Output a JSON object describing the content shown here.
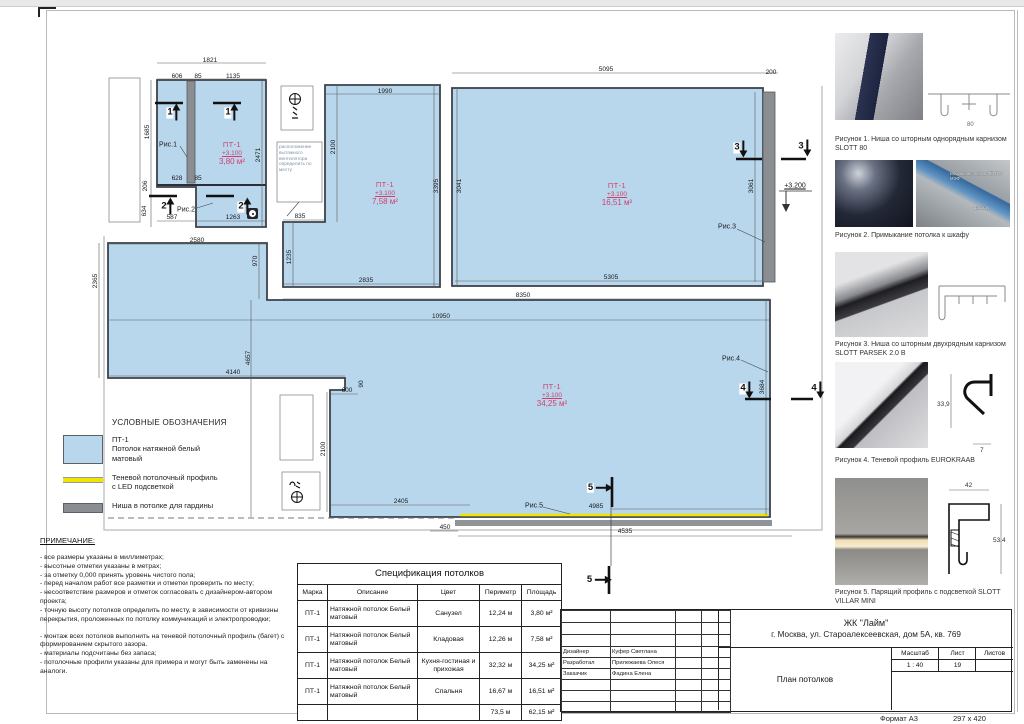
{
  "colors": {
    "ceiling_fill": "#b9d7ec",
    "led_yellow": "#f0e400",
    "niche_gray": "#8a8d92",
    "room_label_pink": "#cf3f6e"
  },
  "plan": {
    "rooms": [
      {
        "mark": "ПТ-1",
        "level": "+3.100",
        "area": "3,80 м²",
        "x": 232,
        "y": 141
      },
      {
        "mark": "ПТ-1",
        "level": "+3.100",
        "area": "7,58 м²",
        "x": 385,
        "y": 181
      },
      {
        "mark": "ПТ-1",
        "level": "+3.100",
        "area": "16,51 м²",
        "x": 617,
        "y": 182
      },
      {
        "mark": "ПТ-1",
        "level": "+3.100",
        "area": "34,25 м²",
        "x": 552,
        "y": 383
      }
    ],
    "niche_level": "+3.200",
    "fan_note": "расположение вытяжного вентилятора определить по месту",
    "dims": [
      {
        "t": "1821",
        "x": 210,
        "y": 61
      },
      {
        "t": "606",
        "x": 177,
        "y": 77
      },
      {
        "t": "85",
        "x": 198,
        "y": 77
      },
      {
        "t": "1135",
        "x": 233,
        "y": 77
      },
      {
        "t": "1685",
        "x": 148,
        "y": 132,
        "v": 1
      },
      {
        "t": "206",
        "x": 146,
        "y": 186,
        "v": 1
      },
      {
        "t": "634",
        "x": 145,
        "y": 211,
        "v": 1
      },
      {
        "t": "628",
        "x": 177,
        "y": 179
      },
      {
        "t": "85",
        "x": 198,
        "y": 179
      },
      {
        "t": "587",
        "x": 172,
        "y": 218
      },
      {
        "t": "1263",
        "x": 233,
        "y": 218
      },
      {
        "t": "2471",
        "x": 259,
        "y": 155,
        "v": 1
      },
      {
        "t": "1990",
        "x": 385,
        "y": 92
      },
      {
        "t": "2100",
        "x": 334,
        "y": 147,
        "v": 1
      },
      {
        "t": "3395",
        "x": 437,
        "y": 186,
        "v": 1
      },
      {
        "t": "835",
        "x": 300,
        "y": 217
      },
      {
        "t": "1235",
        "x": 290,
        "y": 257,
        "v": 1
      },
      {
        "t": "2835",
        "x": 366,
        "y": 281
      },
      {
        "t": "2580",
        "x": 197,
        "y": 241
      },
      {
        "t": "970",
        "x": 256,
        "y": 261,
        "v": 1
      },
      {
        "t": "5095",
        "x": 606,
        "y": 70
      },
      {
        "t": "200",
        "x": 771,
        "y": 73
      },
      {
        "t": "3041",
        "x": 460,
        "y": 186,
        "v": 1
      },
      {
        "t": "3061",
        "x": 752,
        "y": 186,
        "v": 1
      },
      {
        "t": "5305",
        "x": 611,
        "y": 278
      },
      {
        "t": "8350",
        "x": 523,
        "y": 296
      },
      {
        "t": "10950",
        "x": 441,
        "y": 317
      },
      {
        "t": "2365",
        "x": 96,
        "y": 281,
        "v": 1
      },
      {
        "t": "4657",
        "x": 249,
        "y": 358,
        "v": 1
      },
      {
        "t": "4140",
        "x": 233,
        "y": 373
      },
      {
        "t": "600",
        "x": 347,
        "y": 391
      },
      {
        "t": "90",
        "x": 362,
        "y": 384,
        "v": 1
      },
      {
        "t": "2100",
        "x": 324,
        "y": 449,
        "v": 1
      },
      {
        "t": "2405",
        "x": 401,
        "y": 502
      },
      {
        "t": "450",
        "x": 445,
        "y": 528
      },
      {
        "t": "4535",
        "x": 625,
        "y": 532
      },
      {
        "t": "4985",
        "x": 596,
        "y": 507
      },
      {
        "t": "3684",
        "x": 763,
        "y": 387,
        "v": 1
      }
    ],
    "sections": [
      {
        "n": "1",
        "x": 172,
        "y": 113,
        "d": "up"
      },
      {
        "n": "1",
        "x": 230,
        "y": 113,
        "d": "up"
      },
      {
        "n": "2",
        "x": 166,
        "y": 207,
        "d": "up"
      },
      {
        "n": "2",
        "x": 243,
        "y": 207,
        "d": "up"
      },
      {
        "n": "3",
        "x": 739,
        "y": 148,
        "d": "down"
      },
      {
        "n": "3",
        "x": 803,
        "y": 147,
        "d": "down"
      },
      {
        "n": "4",
        "x": 745,
        "y": 389,
        "d": "down"
      },
      {
        "n": "4",
        "x": 816,
        "y": 389,
        "d": "down"
      },
      {
        "n": "5",
        "x": 599,
        "y": 488,
        "d": "right"
      },
      {
        "n": "5",
        "x": 598,
        "y": 580,
        "d": "right"
      }
    ],
    "fig_refs": [
      {
        "t": "Рис.1",
        "x": 168,
        "y": 145
      },
      {
        "t": "Рис.2",
        "x": 186,
        "y": 210
      },
      {
        "t": "Рис.3",
        "x": 727,
        "y": 227
      },
      {
        "t": "Рис.4",
        "x": 731,
        "y": 359
      },
      {
        "t": "Рис.5",
        "x": 534,
        "y": 506
      }
    ]
  },
  "legend": {
    "title": "УСЛОВНЫЕ ОБОЗНАЧЕНИЯ",
    "items": [
      {
        "swatch": "fill",
        "label": "ПТ-1\nПотолок натяжной белый\nматовый"
      },
      {
        "swatch": "led",
        "label": "Теневой потолочный профиль\nс LED подсветкой"
      },
      {
        "swatch": "niche",
        "label": "Ниша в потолке для гардины"
      }
    ]
  },
  "notes": {
    "title": "ПРИМЕЧАНИЕ:",
    "items": [
      "- все размеры указаны в миллиметрах;",
      "- высотные отметки указаны в метрах;",
      "- за отметку 0,000 принять уровень чистого пола;",
      "- перед началом работ все разметки и отметки проверить по месту;",
      "- несоответствие размеров и отметок согласовать с дизайнером-автором проекта;",
      "- точную высоту потолков определить по месту, в зависимости от кривизны перекрытия, проложенных по потолку коммуникаций и электропроводки;",
      "",
      "- монтаж всех потолков выполнить на теневой потолочный профиль (багет) с формированием скрытого зазора.",
      "- материалы подсчитаны без запаса;",
      "- потолочные профили указаны для примера и могут быть заменены на аналоги."
    ]
  },
  "spec_table": {
    "title": "Спецификация потолков",
    "headers": [
      "Марка",
      "Описание",
      "Цвет",
      "Периметр",
      "Площадь"
    ],
    "rows": [
      [
        "ПТ-1",
        "Натяжной потолок Белый матовый",
        "Санузел",
        "12,24 м",
        "3,80 м²"
      ],
      [
        "ПТ-1",
        "Натяжной потолок Белый матовый",
        "Кладовая",
        "12,26 м",
        "7,58 м²"
      ],
      [
        "ПТ-1",
        "Натяжной потолок Белый матовый",
        "Кухня-гостиная и прихожая",
        "32,32 м",
        "34,25 м²"
      ],
      [
        "ПТ-1",
        "Натяжной потолок Белый матовый",
        "Спальня",
        "16,67 м",
        "16,51 м²"
      ]
    ],
    "total": [
      "",
      "",
      "",
      "73,5 м",
      "62,15 м²"
    ]
  },
  "title_block": {
    "project": "ЖК \"Лайм\"",
    "address": "г. Москва, ул. Староалексеевская, дом 5А, кв. 769",
    "roles": [
      {
        "label": "Дизайнер",
        "name": "Куфер Светлана"
      },
      {
        "label": "Разработал",
        "name": "Прилежаева Олеся"
      },
      {
        "label": "Заказчик",
        "name": "Фадина Елена"
      }
    ],
    "drawing_title": "План потолков",
    "scale_label": "Масштаб",
    "scale": "1 : 40",
    "sheet_label": "Лист",
    "sheet": "19",
    "sheets_label": "Листов",
    "sheets": ""
  },
  "footer": {
    "format_label": "Формат А3",
    "format_size": "297 x 420"
  },
  "figures": [
    {
      "caption": "Рисунок 1. Ниша со шторным однорядным карнизом SLOTT 80",
      "dims": [
        "80"
      ]
    },
    {
      "caption": "Рисунок 2. Примыкание потолка к шкафу",
      "photo_labels": [
        "Вобранная плёнка ЛЕОТУ/МЭФ",
        "фасадь"
      ]
    },
    {
      "caption": "Рисунок 3. Ниша со шторным двухрядным карнизом SLOTT PARSEK 2.0 B"
    },
    {
      "caption": "Рисунок 4. Теневой профиль EUROKRAAB",
      "dims": [
        "33,9",
        "7"
      ]
    },
    {
      "caption": "Рисунок 5. Парящий профиль с подсветкой SLOTT VILLAR MINI",
      "dims": [
        "42",
        "53.4"
      ]
    }
  ]
}
